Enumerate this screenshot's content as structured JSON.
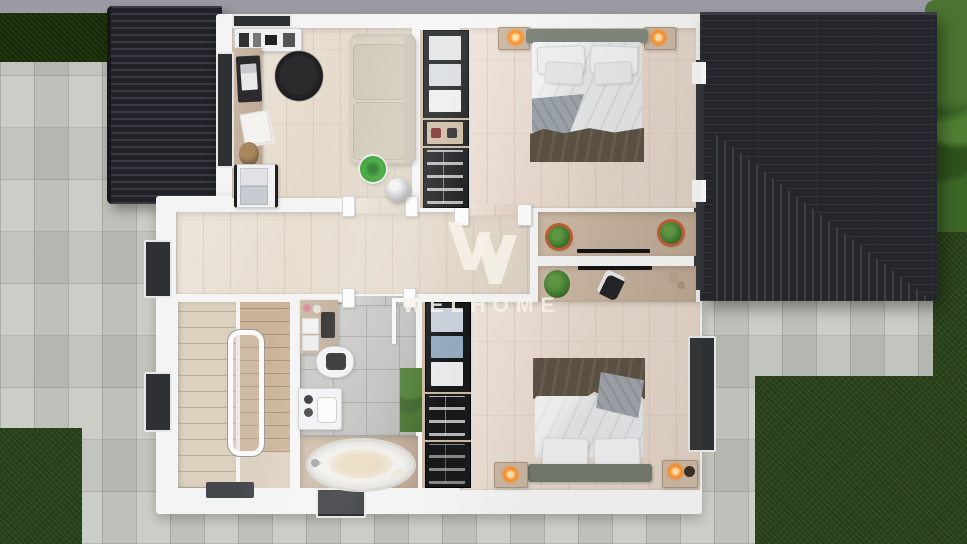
{
  "watermark": {
    "text": "WELHOME",
    "logo": "stylized-double-v-w-logo"
  },
  "colors": {
    "band": "#9b9ba3",
    "wall": "#f4f4f4",
    "paving": "#c6c9c1",
    "grass": "#2d471d",
    "hedge": "#20370f",
    "roof": "#24262b",
    "roof-rib": "#383c42",
    "wood": "#e6dccd",
    "wood-warm": "#e7d8cc",
    "tan": "#c4ae97",
    "tile": "#bcbcba",
    "stairs": "#dcd0bf",
    "stairs-dark": "#cab398",
    "duvet": "#e2e5e6",
    "pillow": "#eef0f0",
    "blanket": "#594f40",
    "fold": "#9ba2a9",
    "headboard": "#7f857a",
    "sofa": "#d8d0bf",
    "lamp": "#ff8d1f",
    "plant": "#3f7c2d",
    "stool": "#2fa32a",
    "watermark": "rgba(247,241,232,0.88)"
  }
}
